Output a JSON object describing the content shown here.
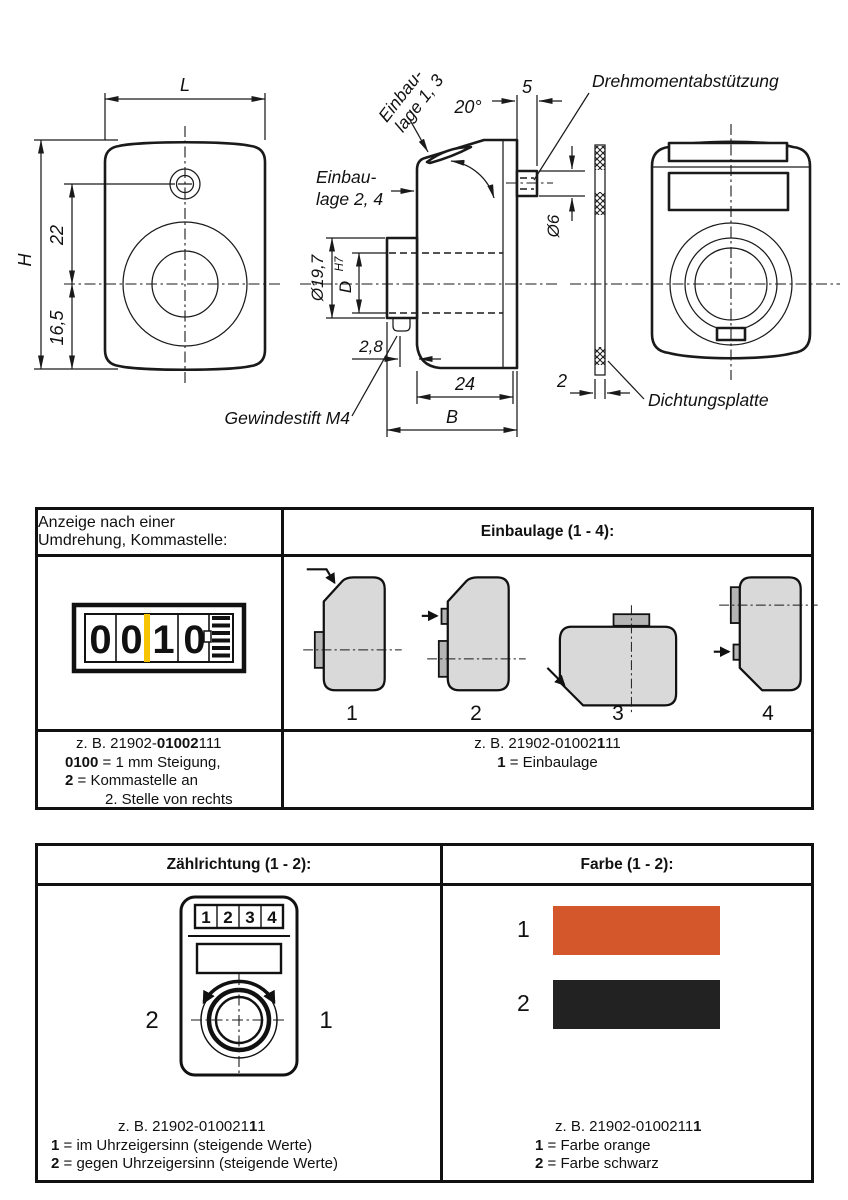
{
  "drawing": {
    "front": {
      "L": "L",
      "H": "H",
      "d22": "22",
      "d165": "16,5"
    },
    "side": {
      "einbau13_1": "Einbau-",
      "einbau13_2": "lage 1, 3",
      "einbau24_1": "Einbau-",
      "einbau24_2": "lage 2, 4",
      "angle": "20°",
      "d5": "5",
      "d6": "Ø6",
      "d197": "Ø19,7",
      "D": "D",
      "D_tol": "H7",
      "d28": "2,8",
      "d24": "24",
      "B": "B",
      "gewindestift": "Gewindestift M4"
    },
    "seal": {
      "d2": "2",
      "dichtungsplatte": "Dichtungsplatte"
    },
    "back": {
      "drehmoment": "Drehmomentabstützung"
    }
  },
  "middle_table": {
    "left_header_l1": "Anzeige nach einer",
    "left_header_l2": "Umdrehung, Kommastelle:",
    "right_header": "Einbaulage (1 - 4):",
    "counter_digits": [
      "0",
      "0",
      "1",
      "0"
    ],
    "comma_color": "#f6c400",
    "positions": [
      "1",
      "2",
      "3",
      "4"
    ],
    "left_note": {
      "l1_pre": "z. B.  21902-",
      "l1_bold": "01002",
      "l1_suf": "111",
      "l2_bold": "0100",
      "l2_rest": " = 1 mm Steigung,",
      "l3_bold": "2",
      "l3_rest": " = Kommastelle an",
      "l4": "2. Stelle von rechts"
    },
    "right_note": {
      "l1_pre": "z. B. 21902-01002",
      "l1_bold": "1",
      "l1_suf": "11",
      "l2_bold": "1",
      "l2_rest": " = Einbaulage"
    }
  },
  "bottom_table": {
    "left_header": "Zählrichtung (1 - 2):",
    "right_header": "Farbe (1 - 2):",
    "dial_digits": [
      "1",
      "2",
      "3",
      "4"
    ],
    "dir_left": "2",
    "dir_right": "1",
    "left_note": {
      "l1_pre": "z. B.  21902-010021",
      "l1_bold": "1",
      "l1_suf": "1",
      "l2_bold": "1",
      "l2_rest": " = im Uhrzeigersinn (steigende Werte)",
      "l3_bold": "2",
      "l3_rest": " = gegen Uhrzeigersinn (steigende Werte)"
    },
    "swatches": [
      {
        "label": "1",
        "color": "#d4572b"
      },
      {
        "label": "2",
        "color": "#222222"
      }
    ],
    "right_note": {
      "l1_pre": "z. B. 21902-0100211",
      "l1_bold": "1",
      "l2_bold": "1",
      "l2_rest": " = Farbe orange",
      "l3_bold": "2",
      "l3_rest": " = Farbe schwarz"
    }
  }
}
